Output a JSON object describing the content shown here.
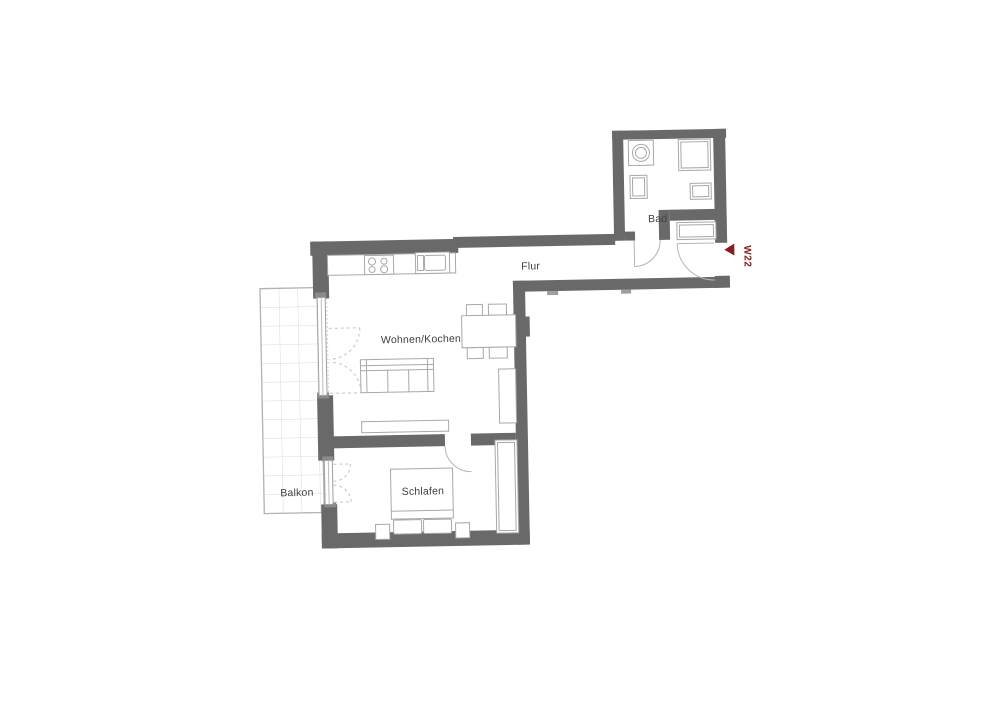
{
  "plan": {
    "unit": {
      "label": "W22",
      "marker_color": "#8b1c20"
    },
    "rooms": {
      "bad": {
        "label": "Bad"
      },
      "flur": {
        "label": "Flur"
      },
      "wohnen_kochen": {
        "label": "Wohnen/Kochen"
      },
      "schlafen": {
        "label": "Schlafen"
      },
      "balkon": {
        "label": "Balkon"
      }
    },
    "colors": {
      "wall": "#696969",
      "furniture_line": "#a8a8a8",
      "door_arc": "#b5b5b5",
      "dashed_swing": "#c4c4c4",
      "label_text": "#404040",
      "balcony_grid": "#d8d8d8",
      "background": "#ffffff"
    }
  }
}
